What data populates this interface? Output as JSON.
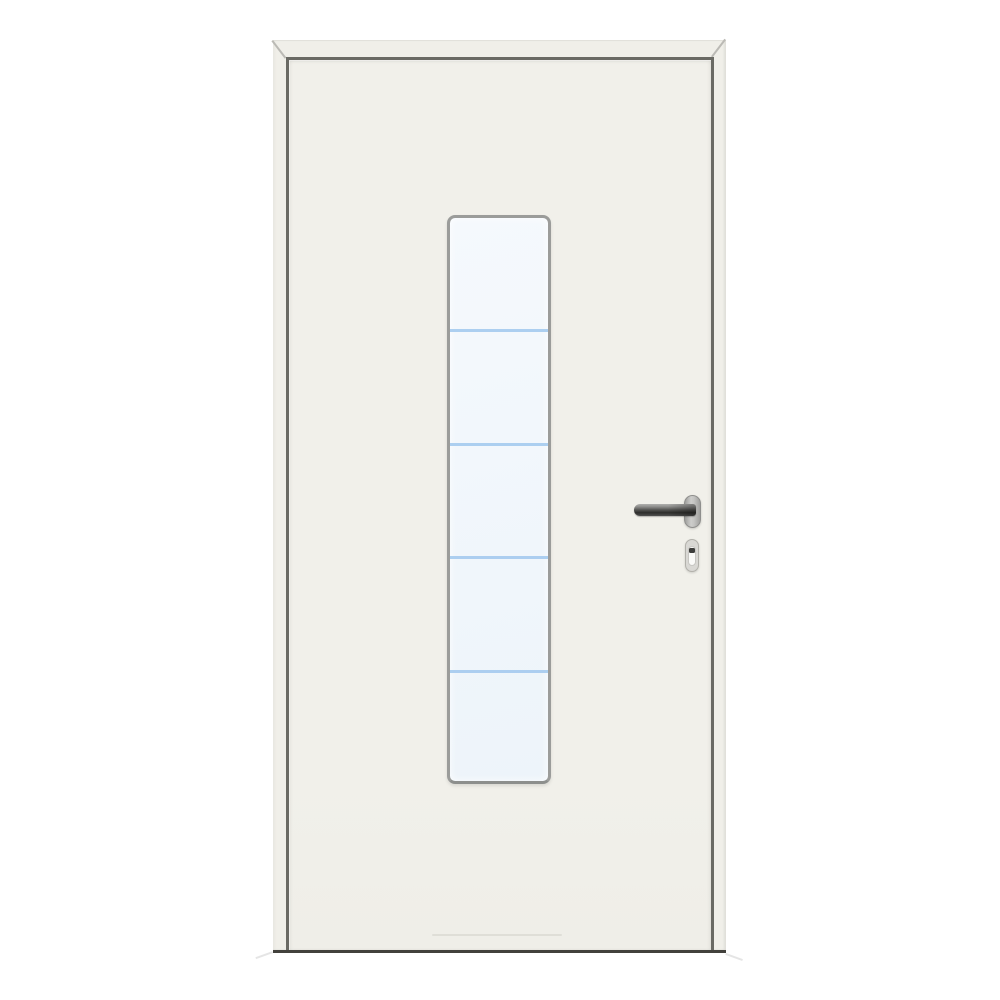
{
  "scene": {
    "type": "product-photo",
    "subject": "white-entry-door-with-vertical-glazing",
    "description": "White entry door hung in a white frame, with a tall narrow vertical glass panel divided into five sections by four horizontal light-blue lines, a stainless-steel lever handle on an oval rosette pointing left, and a profile-cylinder escutcheon with keyhole below the handle"
  },
  "glazing": {
    "sections": 5,
    "divider_lines": 4
  },
  "hardware": {
    "handle": "stainless-steel-lever-handle",
    "rosette": "oval-rosette",
    "cylinder_cover": "profile-cylinder-escutcheon-with-keyhole"
  },
  "colors": {
    "bg": "#ffffff",
    "frame": "#f0efe9",
    "frame_edge": "#e2e1db",
    "miter": "#bbbab5",
    "gap": "#6a6a64",
    "leaf": "#f1f0ea",
    "bottom_edge": "#42413c",
    "seam": "rgba(110,110,100,0.12)",
    "glass_frame": "#9b9c9a",
    "glass_top": "#f5f9fd",
    "glass_bottom": "#edf4fa",
    "glass_line": "#a4caee",
    "lever_light": "#b0b0ae",
    "lever_dark": "#2e2e2c",
    "rosette_light": "#cdcdcb",
    "rosette_dark": "#a0a09e",
    "rosette_border": "#8f8f8d",
    "esc_fill": "#d9d8d4",
    "esc_border": "#b2b1ab",
    "esc_inner": "#fafaf8",
    "esc_inner_border": "#c7c6c2",
    "keyhole": "#3d3d3b"
  }
}
